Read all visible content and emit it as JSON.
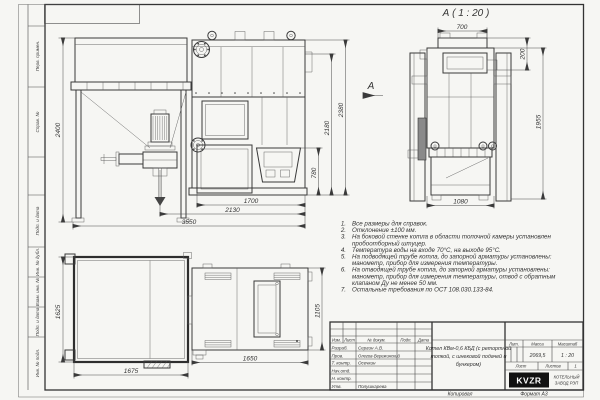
{
  "margins": {
    "top": [
      "Перв. примен.",
      "Справ. №"
    ],
    "bottom": [
      "Подп. и дата",
      "Инв. № дубл.",
      "Взам. инв. №",
      "Подп. и дата",
      "Инв. № подл."
    ]
  },
  "views": {
    "front": {
      "arrow_label": "А",
      "dims": {
        "height_bunker": "2400",
        "door": "780",
        "body_h": "2180",
        "total_h": "2380",
        "firebox_w": "1700",
        "body_w": "2130",
        "total_w": "3550"
      }
    },
    "side": {
      "title": "А ( 1 : 20 )",
      "dims": {
        "top": "700",
        "collar": "200",
        "height": "1955",
        "width": "1080"
      }
    },
    "plan": {
      "dims": {
        "bunker_h": "1625",
        "bunker_w": "1675",
        "boiler_w": "1650",
        "boiler_h": "1105"
      }
    }
  },
  "notes": {
    "lines": [
      {
        "n": "1.",
        "t": "Все размеры для справок."
      },
      {
        "n": "2.",
        "t": "Отклонение ±100 мм."
      },
      {
        "n": "3.",
        "t": "На боковой стенке котла в области топочной камеры установлен"
      },
      {
        "n": "",
        "t": "пробоотборный штуцер."
      },
      {
        "n": "4.",
        "t": "Температура воды на входе 70°С, на выходе 95°С."
      },
      {
        "n": "5.",
        "t": "На подводящей трубе котла, до запорной арматуры установлены:"
      },
      {
        "n": "",
        "t": "манометр, прибор для измерения температуры."
      },
      {
        "n": "6.",
        "t": "На отводящей трубе котла, до запорной арматуры установлены:"
      },
      {
        "n": "",
        "t": "манометр, прибор для измерения температуры, отвод с обратным"
      },
      {
        "n": "",
        "t": "клапаном Ду не менее 50 мм."
      },
      {
        "n": "7.",
        "t": "Остальные требования по ОСТ 108.030.133-84."
      }
    ]
  },
  "title_block": {
    "header": {
      "izm": "Изм.",
      "list": "Лист",
      "doc": "№ докум.",
      "sign": "Подп.",
      "date": "Дата"
    },
    "rows": [
      {
        "role": "Разраб.",
        "name": "Сергин А.В."
      },
      {
        "role": "Пров.",
        "name": "Олегов-Вережинский"
      },
      {
        "role": "Т. контр.",
        "name": "Осечкин"
      },
      {
        "role": "Нач.отд.",
        "name": ""
      },
      {
        "role": "Н. контр.",
        "name": ""
      },
      {
        "role": "Утв.",
        "name": "Полушкарева"
      }
    ],
    "doc_title_lines": [
      "Котел КВм-0,6 КБД (с ретортной",
      "топкой, с шнековой подачей и",
      "бункером)"
    ],
    "lit_label": "Лит.",
    "mass_label": "Масса",
    "scale_label": "Масштаб",
    "mass": "2069,5",
    "scale": "1 : 20",
    "sheet_label": "Лист",
    "sheets_label": "Листов",
    "sheets_value": "1",
    "logo": "KVZR",
    "company_lines": [
      "КОТЕЛЬНЫЙ",
      "ЗАВОД РЭП"
    ]
  },
  "footer": {
    "copy": "Копировал",
    "format": "Формат А3"
  },
  "colors": {
    "paper": "#f6f6f3",
    "line": "#3a3a3a",
    "logo_bg": "#111111"
  }
}
